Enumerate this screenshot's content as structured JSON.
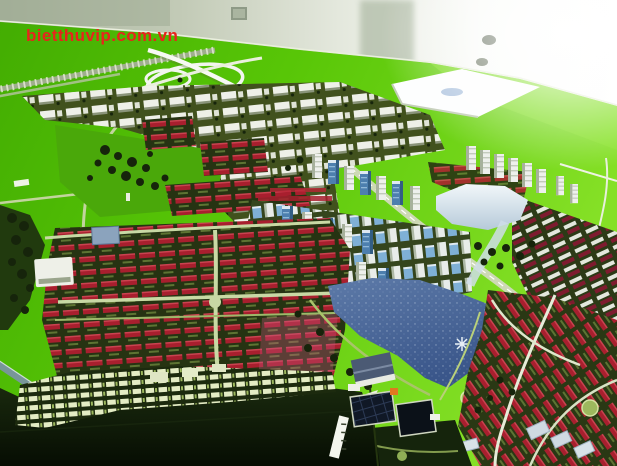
{
  "watermark": {
    "text": "bietthuvip.com.vn",
    "color": "#e8241c"
  },
  "scene": {
    "subject": "aerial view of an architectural scale model of an urban master plan on a bright green baseboard",
    "setting": "indoor showroom, pale wall and pillar behind the model table, overexposed light at top right",
    "features": [
      "highway interchange and railway on green field (top left)",
      "white flat site-plan board lying on the green (top right)",
      "district of white mid-rise blocks with red-roof courtyard clusters (upper left)",
      "diagonal rows of white high-rise towers (center right)",
      "cluster of blue-glass high-rise towers (center)",
      "white reflective lake with stream (right)",
      "large blue lake with fountain marker (bottom center)",
      "rows of red-roofed low-rise houses (lower left, right and bottom right)",
      "dark unbuilt model base with illuminated strip of small buildings (bottom left)",
      "dark photovoltaic-roof building with orange accent (bottom center)",
      "white tilted road-label strip and chevron markers (bottom center-left)"
    ],
    "palette": {
      "wall_grey": "#a9b49e",
      "wall_light": "#ffffff",
      "grass_main": "#58c607",
      "grass_bright": "#85e026",
      "grass_deep": "#43ad02",
      "ground_olive": "#41511d",
      "ground_dark": "#2c3a13",
      "base_dark": "#0c1505",
      "road_pale": "#c8d9a4",
      "road_white": "#f2f5ee",
      "road_lime": "#9db85e",
      "bldg_white": "#eef0e8",
      "bldg_shadow": "#8a947a",
      "glass_blue": "#7fb0d6",
      "glass_deep": "#4d7fae",
      "roof_red": "#a81f2e",
      "roof_maroon": "#7e1b2f",
      "roof_pink": "#c2527a",
      "lake_blue": "#4a699e",
      "lake_white": "#dce8f0",
      "tree_dark": "#16240b",
      "panel_dark": "#101826",
      "accent_orange": "#e07820",
      "watermark_red": "#e8241c"
    }
  }
}
